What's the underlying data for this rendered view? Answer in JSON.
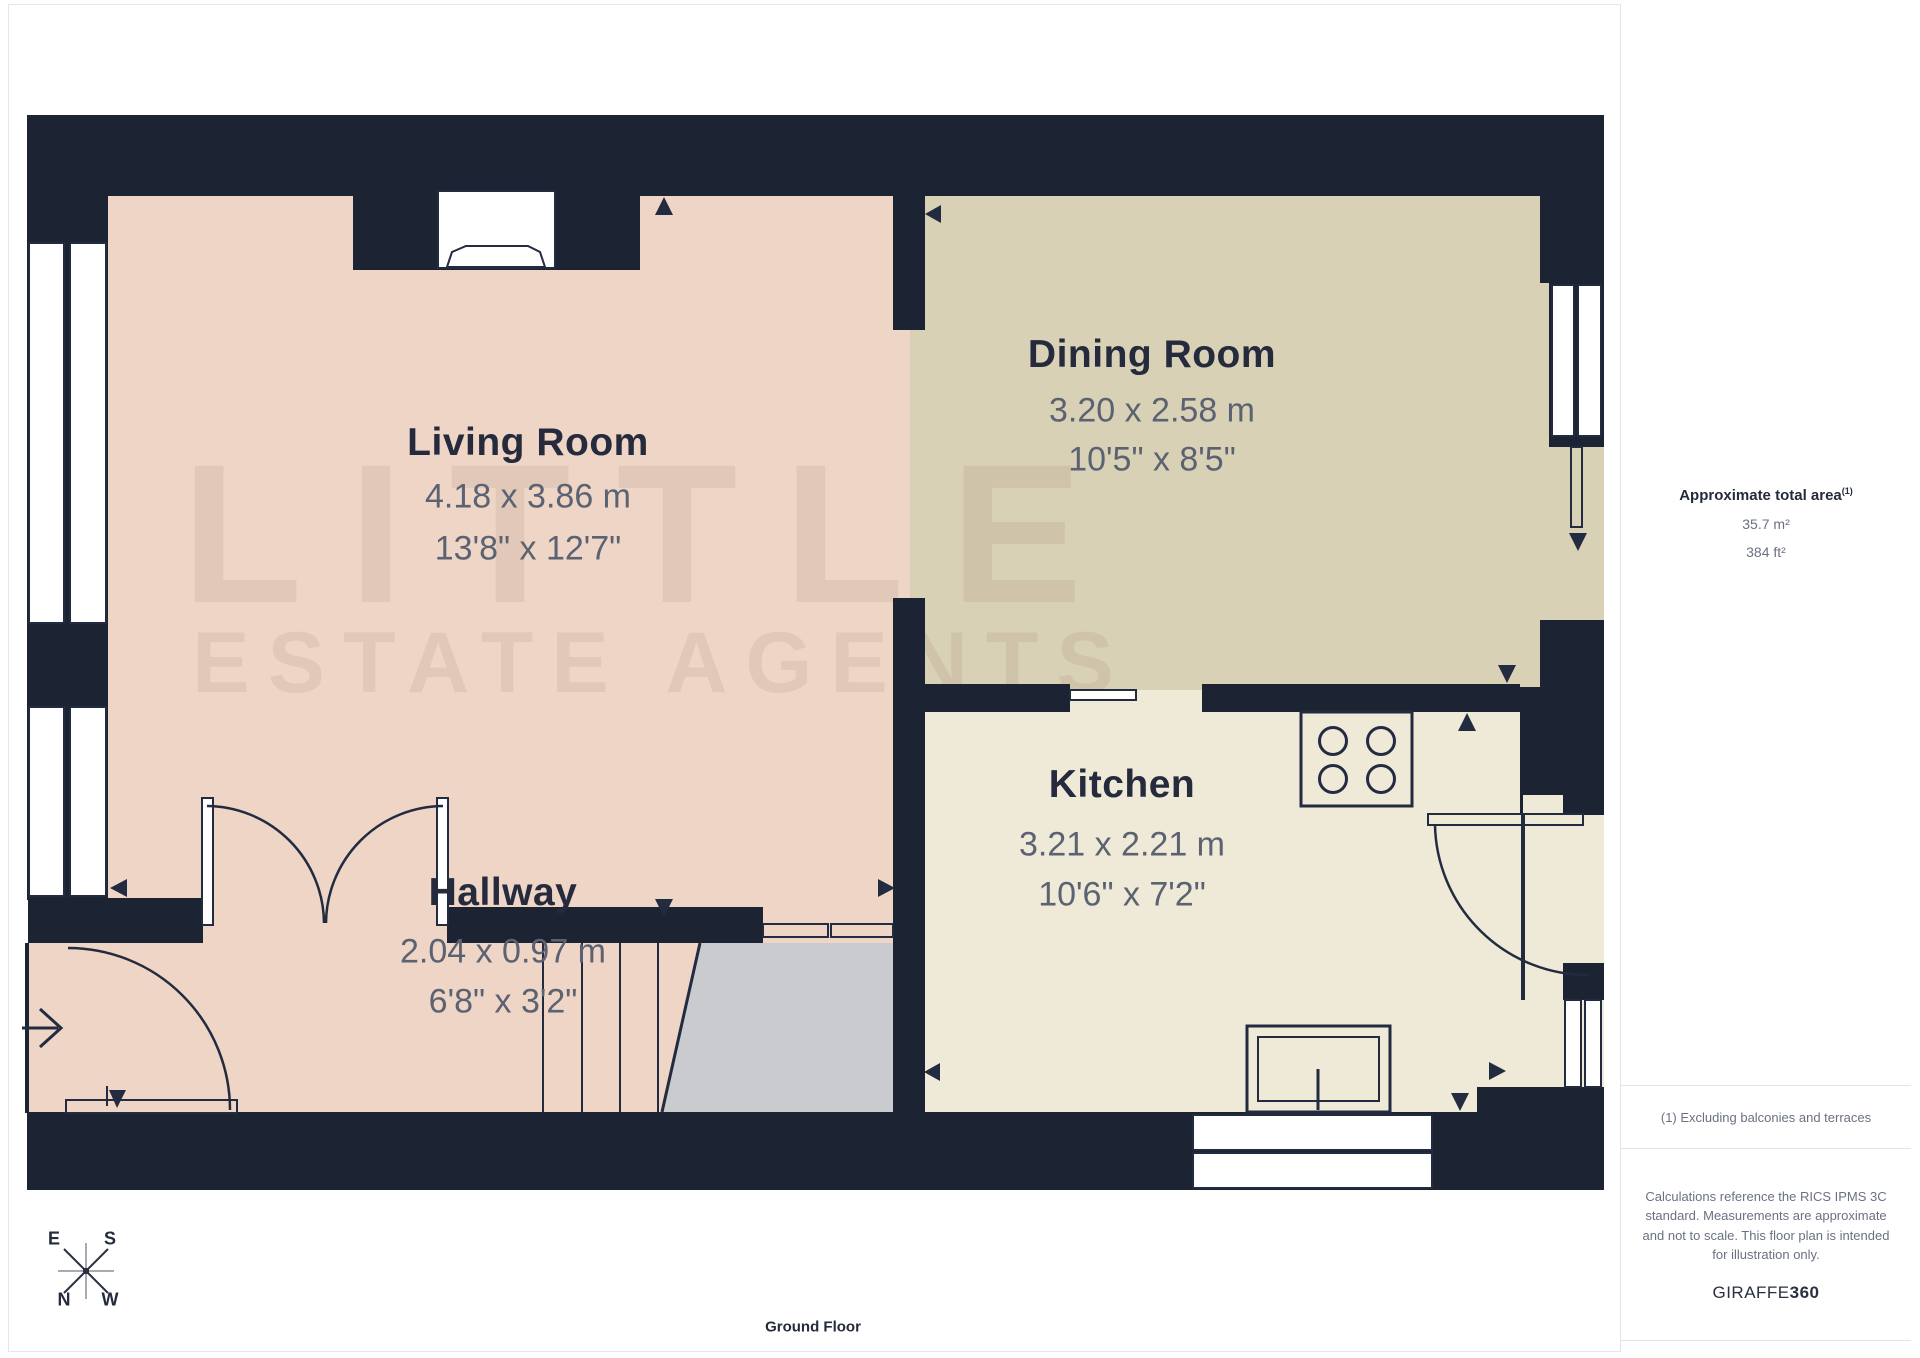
{
  "floorplan": {
    "title": "Ground Floor",
    "rooms": [
      {
        "name": "Living Room",
        "metric": "4.18 x 3.86 m",
        "imperial": "13'8\" x 12'7\""
      },
      {
        "name": "Dining Room",
        "metric": "3.20 x 2.58 m",
        "imperial": "10'5\" x 8'5\""
      },
      {
        "name": "Kitchen",
        "metric": "3.21 x 2.21 m",
        "imperial": "10'6\" x 7'2\""
      },
      {
        "name": "Hallway",
        "metric": "2.04 x 0.97 m",
        "imperial": "6'8\" x 3'2\""
      }
    ],
    "compass": {
      "n": "N",
      "e": "E",
      "s": "S",
      "w": "W"
    },
    "watermark_line1": "LITTLE",
    "watermark_line2": "ESTATE AGENTS"
  },
  "sidebar": {
    "area_title": "Approximate total area",
    "area_title_sup": "(1)",
    "area_m2": "35.7 m²",
    "area_ft2": "384 ft²",
    "note1": "(1) Excluding balconies and terraces",
    "note2": "Calculations reference the RICS IPMS 3C standard. Measurements are approximate and not to scale. This floor plan is intended for illustration only.",
    "brand_name": "GIRAFFE",
    "brand_suffix": "360"
  },
  "colors": {
    "wall": "#1c2333",
    "living_floor": "#eed5c6",
    "dining_floor": "#d9d1b6",
    "kitchen_floor": "#efe9d7",
    "stairs": "#c9cbce",
    "label_text": "#252b3d",
    "dimension_text": "#5b6272",
    "divider": "#e3e3e5"
  }
}
